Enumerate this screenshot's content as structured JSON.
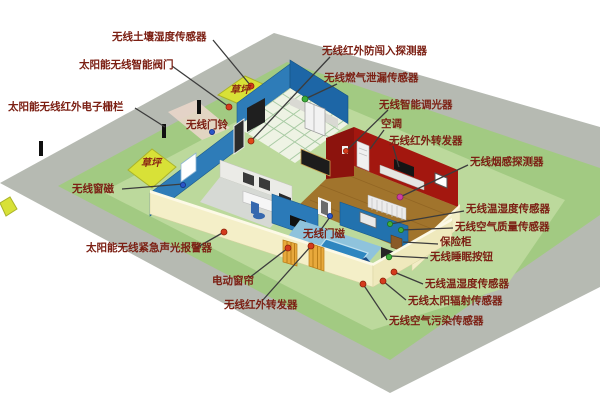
{
  "diagram_title": "智能家居无线传感器户型布局示意图",
  "palette": {
    "pavement_gray": "#b6bab2",
    "field_green": "#a2ca82",
    "yard_green": "#bcd99c",
    "lawn_patch": "#d8e137",
    "fence_yellow": "#f4efc8",
    "wall_blue": "#2b7ab8",
    "wall_red": "#a3170f",
    "floor_brown": "#a1742c",
    "label_text": "#7c2014",
    "marker_red": "#d43b1d",
    "marker_green": "#3fae3c",
    "marker_blue": "#2a55c8",
    "marker_magenta": "#cc3fa0"
  },
  "labels": [
    {
      "id": "soil-moisture",
      "text": "无线土壤湿度传感器",
      "marker": "#d43b1d"
    },
    {
      "id": "smart-valve",
      "text": "太阳能无线智能阀门",
      "marker": "#d43b1d"
    },
    {
      "id": "ir-electronic-fence",
      "text": "太阳能无线红外电子栅栏",
      "marker": "none"
    },
    {
      "id": "doorbell",
      "text": "无线门铃",
      "marker": "#2a55c8"
    },
    {
      "id": "lawn-top",
      "text": "草坪",
      "marker": "none"
    },
    {
      "id": "lawn-left",
      "text": "草坪",
      "marker": "none"
    },
    {
      "id": "window-magnet",
      "text": "无线窗磁",
      "marker": "#2a55c8"
    },
    {
      "id": "emergency-alarm",
      "text": "太阳能无线紧急声光报警器",
      "marker": "#d43b1d"
    },
    {
      "id": "electric-curtain",
      "text": "电动窗帘",
      "marker": "#d43b1d"
    },
    {
      "id": "ir-repeater-bottom",
      "text": "无线红外转发器",
      "marker": "#d43b1d"
    },
    {
      "id": "ir-intrusion-detector",
      "text": "无线红外防闯入探测器",
      "marker": "#d43b1d"
    },
    {
      "id": "gas-leak-sensor",
      "text": "无线燃气泄漏传感器",
      "marker": "#3fae3c"
    },
    {
      "id": "smart-dimmer",
      "text": "无线智能调光器",
      "marker": "#d43b1d"
    },
    {
      "id": "air-conditioner",
      "text": "空调",
      "marker": "none"
    },
    {
      "id": "ir-repeater-right",
      "text": "无线红外转发器",
      "marker": "none"
    },
    {
      "id": "smoke-detector",
      "text": "无线烟感探测器",
      "marker": "#cc3fa0"
    },
    {
      "id": "temp-humidity-sensor-1",
      "text": "无线温湿度传感器",
      "marker": "#3fae3c"
    },
    {
      "id": "air-quality-sensor",
      "text": "无线空气质量传感器",
      "marker": "#3fae3c"
    },
    {
      "id": "safe-box",
      "text": "保险柜",
      "marker": "none"
    },
    {
      "id": "sleep-button",
      "text": "无线睡眠按钮",
      "marker": "#3fae3c"
    },
    {
      "id": "temp-humidity-sensor-2",
      "text": "无线温湿度传感器",
      "marker": "#d43b1d"
    },
    {
      "id": "solar-radiation-sensor",
      "text": "无线太阳辐射传感器",
      "marker": "#d43b1d"
    },
    {
      "id": "air-pollution-sensor",
      "text": "无线空气污染传感器",
      "marker": "#d43b1d"
    },
    {
      "id": "door-magnet",
      "text": "无线门磁",
      "marker": "#2a55c8"
    }
  ]
}
